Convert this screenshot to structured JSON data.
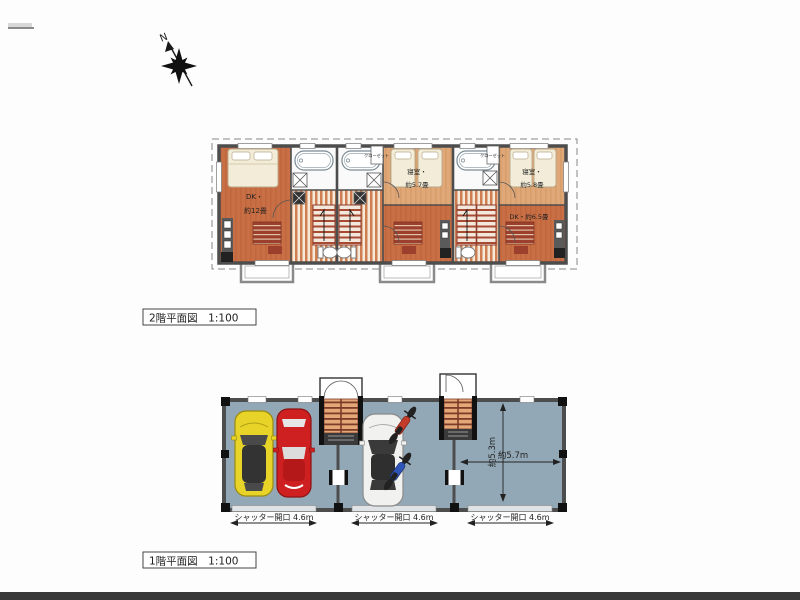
{
  "compass": {
    "label": "N"
  },
  "floor2": {
    "caption": "2階平面図　1:100",
    "unit1": {
      "label": "DK・",
      "size": "約12畳"
    },
    "unit2": {
      "room_label": "寝室・",
      "room_size": "約5.7畳",
      "closet": "クローゼット"
    },
    "unit3": {
      "room_label": "寝室・",
      "room_size": "約5.8畳",
      "dk_label": "DK・約6.5畳",
      "closet": "クローゼット"
    }
  },
  "floor1": {
    "caption": "1階平面図　1:100",
    "shutters": [
      "シャッター開口 4.6m",
      "シャッター開口 4.6m",
      "シャッター開口 4.6m"
    ],
    "dim_depth": "約5.3m",
    "dim_width": "約5.7m"
  },
  "colors": {
    "dk_floor": "#c96f45",
    "bedroom_floor": "#e0a878",
    "hall_stripe": "#cf7e52",
    "bath_floor": "#fafafa",
    "garage_floor": "#93a8b6",
    "wall": "#4d4d4d",
    "stair_tread": "#a84a33",
    "car_yellow": "#e8d428",
    "car_red": "#ce2020",
    "car_white": "#f1f1ef",
    "motorcycle_red": "#c43b2a",
    "motorcycle_blue": "#2f55b8",
    "balcony_outline": "#8a8a8a"
  }
}
